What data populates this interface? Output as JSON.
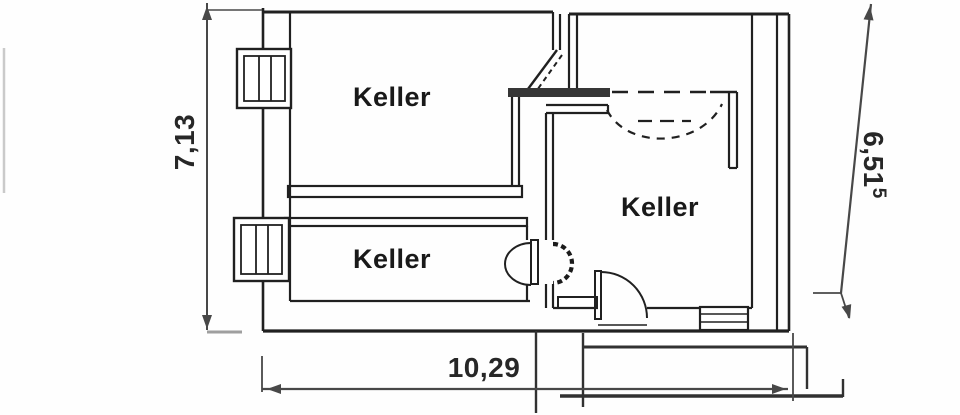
{
  "floor_plan": {
    "rooms": [
      {
        "label": "Keller"
      },
      {
        "label": "Keller"
      },
      {
        "label": "Keller"
      }
    ],
    "dimensions": {
      "left_vertical": "7,13",
      "bottom_horizontal": "10,29",
      "right_vertical": "6,51",
      "right_vertical_superscript": "5"
    },
    "colors": {
      "ink": "#232323",
      "dimension_line": "#4a4a4a",
      "paper": "#ffffff"
    }
  }
}
